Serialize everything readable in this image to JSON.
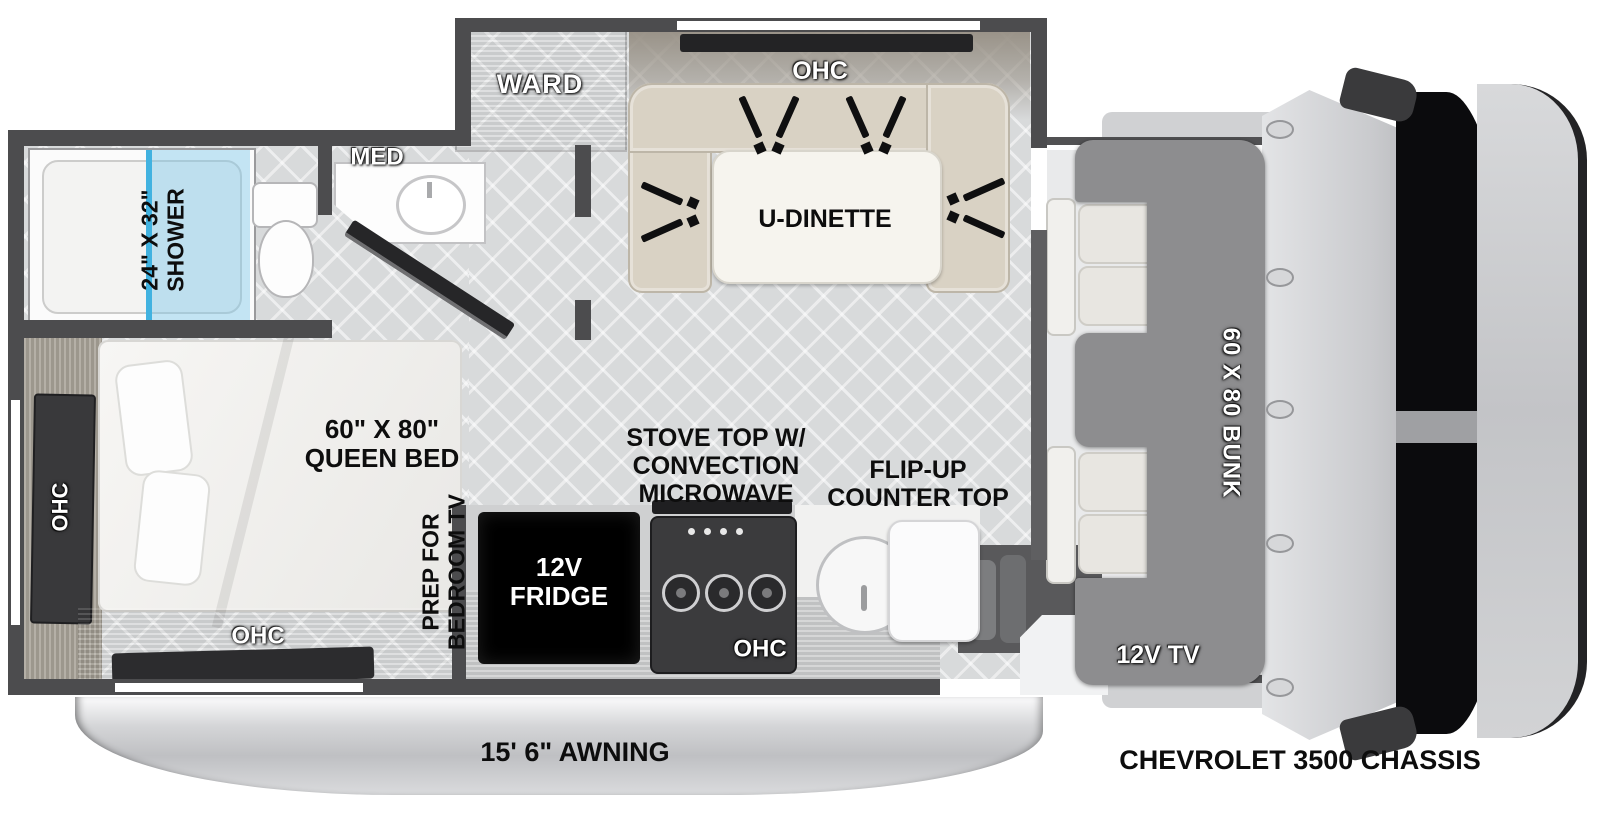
{
  "labels": {
    "shower": [
      "24\" X 32\"",
      "SHOWER"
    ],
    "med": "MED",
    "ward": "WARD",
    "ohc_dinette": "OHC",
    "u_dinette": "U-DINETTE",
    "queen_bed": [
      "60\" X 80\"",
      "QUEEN BED"
    ],
    "ohc_rear": "OHC",
    "ohc_bedroom": "OHC",
    "prep_tv": [
      "PREP FOR",
      "BEDROOM TV"
    ],
    "stove": [
      "STOVE TOP W/",
      "CONVECTION",
      "MICROWAVE"
    ],
    "flip_counter": [
      "FLIP-UP",
      "COUNTER TOP"
    ],
    "fridge": [
      "12V",
      "FRIDGE"
    ],
    "ohc_kitchen": "OHC",
    "bunk": "60 X 80 BUNK",
    "tv": "12V TV",
    "awning": "15' 6\" AWNING",
    "chassis": "CHEVROLET 3500 CHASSIS"
  },
  "colors": {
    "wall": "#4c4c4e",
    "floor": "#d8dadb",
    "wood": "#a49d93",
    "dinette_cushion": "#d9d2c4",
    "bunk_overlay": "#8d8d8f",
    "shower_glass": "#7ec8e8",
    "shower_accent": "#41b2e0",
    "fridge": "#000000",
    "windshield": "#0b0b0d",
    "cab_body": "#d3d4d6",
    "awning": "#c9cacc",
    "label_black": "#0d0d0d",
    "label_white": "#ffffff"
  }
}
